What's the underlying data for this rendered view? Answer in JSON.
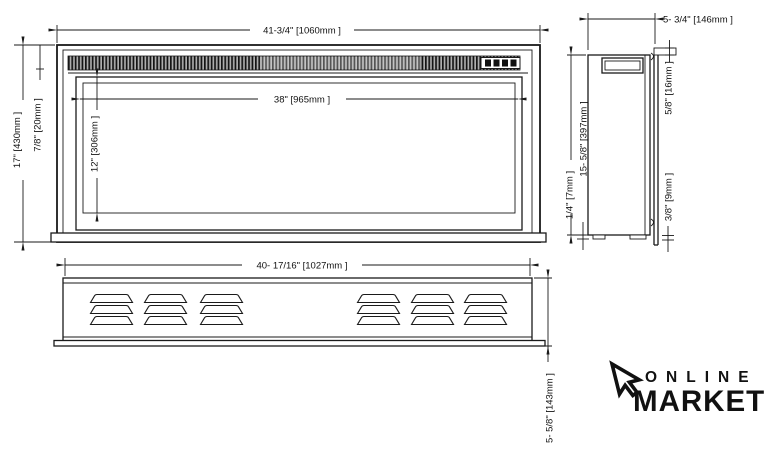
{
  "dims": {
    "front_width": "41-3/4\" [1060mm ]",
    "front_height": "17\" [430mm ]",
    "front_grille": "7/8\" [20mm ]",
    "glass_width": "38\" [965mm ]",
    "glass_height": "12\" [306mm ]",
    "side_depth": "5- 3/4\" [146mm ]",
    "side_top_lip": "5/8\" [16mm ]",
    "side_height": "15- 5/8\" [397mm ]",
    "side_bottom_gap": "1/4\" [7mm ]",
    "side_bottom_lip": "3/8\" [9mm ]",
    "bottom_width": "40- 17/16\" [1027mm ]",
    "bottom_depth": "5- 5/8\" [143mm ]"
  },
  "logo": {
    "line1": "ONLINE",
    "line2": "MARKET"
  },
  "colors": {
    "line": "#1a1a1a",
    "background": "#ffffff",
    "grille_dark": "#141414",
    "grille_light": "#aeaeae"
  }
}
